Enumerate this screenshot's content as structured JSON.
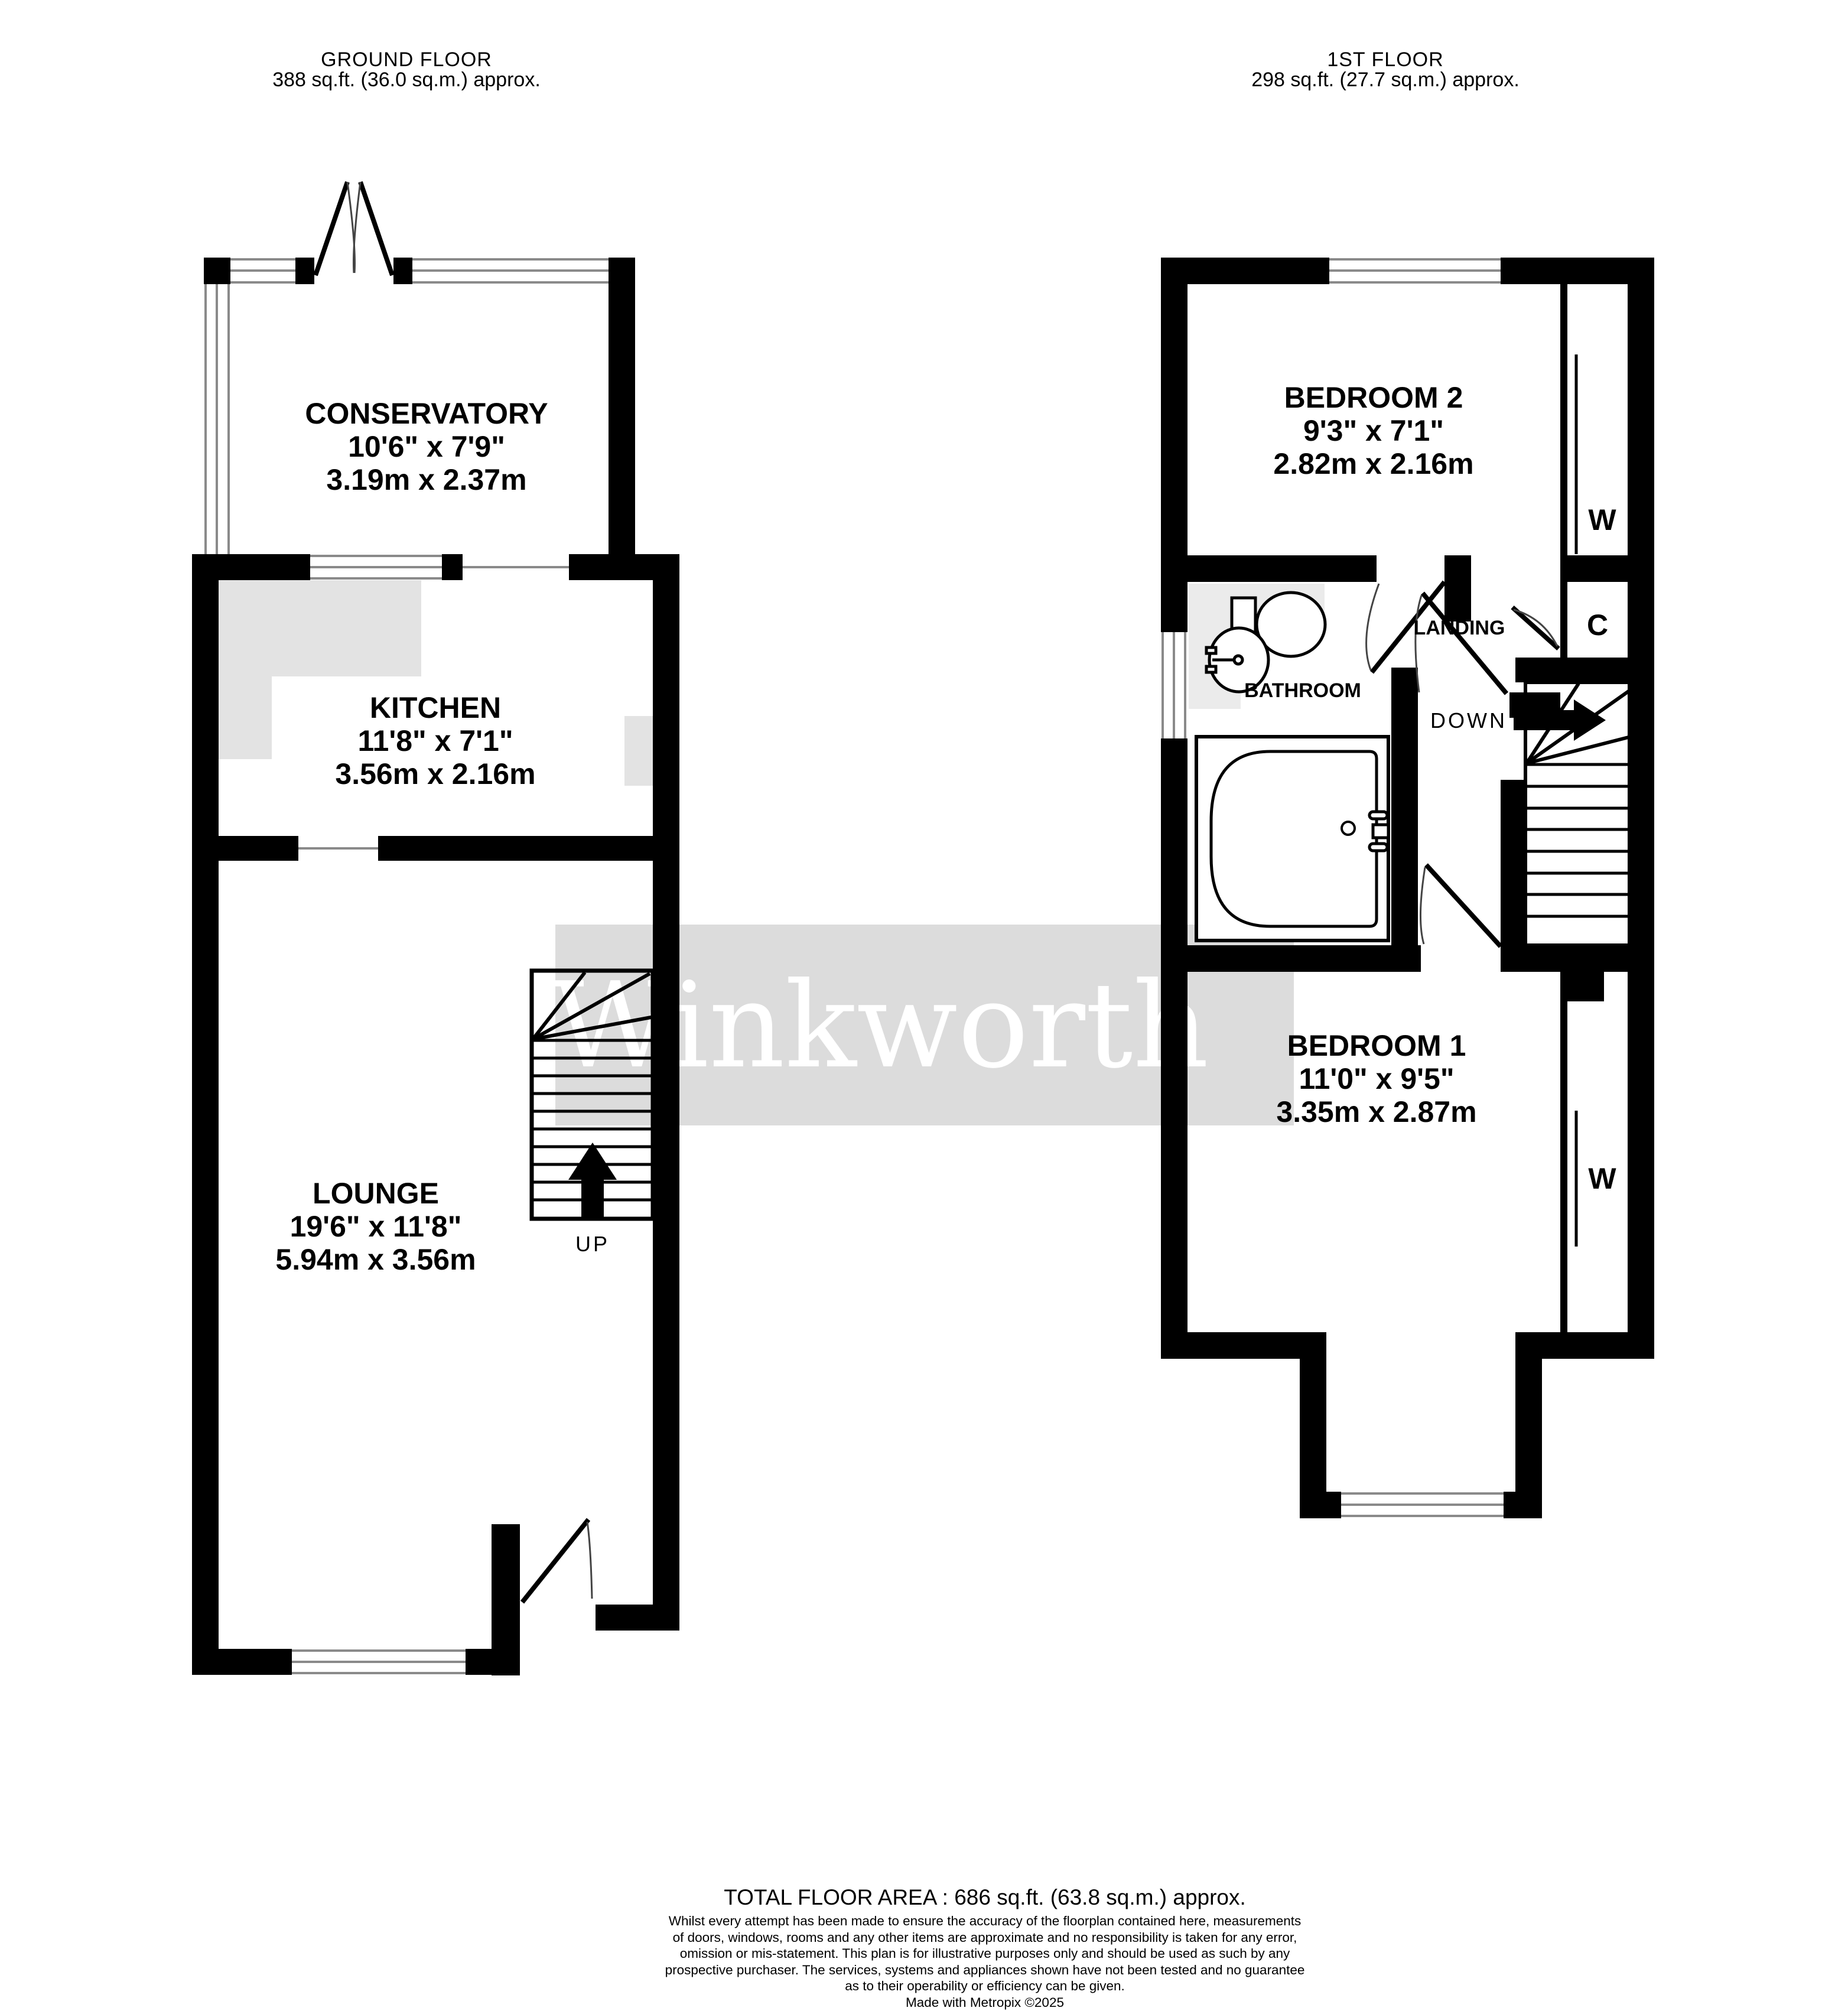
{
  "headers": {
    "ground": {
      "title": "GROUND FLOOR",
      "area": "388 sq.ft. (36.0 sq.m.) approx."
    },
    "first": {
      "title": "1ST FLOOR",
      "area": "298 sq.ft. (27.7 sq.m.) approx."
    }
  },
  "ground_floor": {
    "rooms": {
      "conservatory": {
        "name": "CONSERVATORY",
        "imperial": "10'6\"  x 7'9\"",
        "metric": "3.19m  x 2.37m"
      },
      "kitchen": {
        "name": "KITCHEN",
        "imperial": "11'8\"  x 7'1\"",
        "metric": "3.56m  x 2.16m"
      },
      "lounge": {
        "name": "LOUNGE",
        "imperial": "19'6\"  x 11'8\"",
        "metric": "5.94m  x 3.56m"
      }
    },
    "stairs_label": "UP"
  },
  "first_floor": {
    "rooms": {
      "bedroom2": {
        "name": "BEDROOM 2",
        "imperial": "9'3\"  x 7'1\"",
        "metric": "2.82m  x 2.16m"
      },
      "bedroom1": {
        "name": "BEDROOM 1",
        "imperial": "11'0\"  x 9'5\"",
        "metric": "3.35m  x 2.87m"
      }
    },
    "labels": {
      "landing": "LANDING",
      "bathroom": "BATHROOM",
      "cupboard": "C",
      "wardrobe_bedroom2": "W",
      "wardrobe_bedroom1": "W"
    },
    "stairs_label": "DOWN"
  },
  "watermark": {
    "text": "Winkworth",
    "bg": "#dcdcdc",
    "fg": "#ffffff"
  },
  "footer": {
    "total_area": "TOTAL FLOOR AREA : 686 sq.ft. (63.8 sq.m.) approx.",
    "disclaimer_lines": [
      "Whilst every attempt has been made to ensure the accuracy of the floorplan contained here, measurements",
      "of doors, windows, rooms and any other items are approximate and no responsibility is taken for any error,",
      "omission or mis-statement. This plan is for illustrative purposes only and should be used as such by any",
      "prospective purchaser. The services, systems and appliances shown have not been tested and no guarantee",
      "as to their operability or efficiency can be given."
    ],
    "credit": "Made with Metropix ©2025"
  },
  "colors": {
    "wall": "#000000",
    "window_line": "#8a8a8a",
    "counter": "#e3e3e3",
    "splash": "#ebebeb",
    "watermark_bg": "#dcdcdc",
    "door_arc": "#444444"
  }
}
